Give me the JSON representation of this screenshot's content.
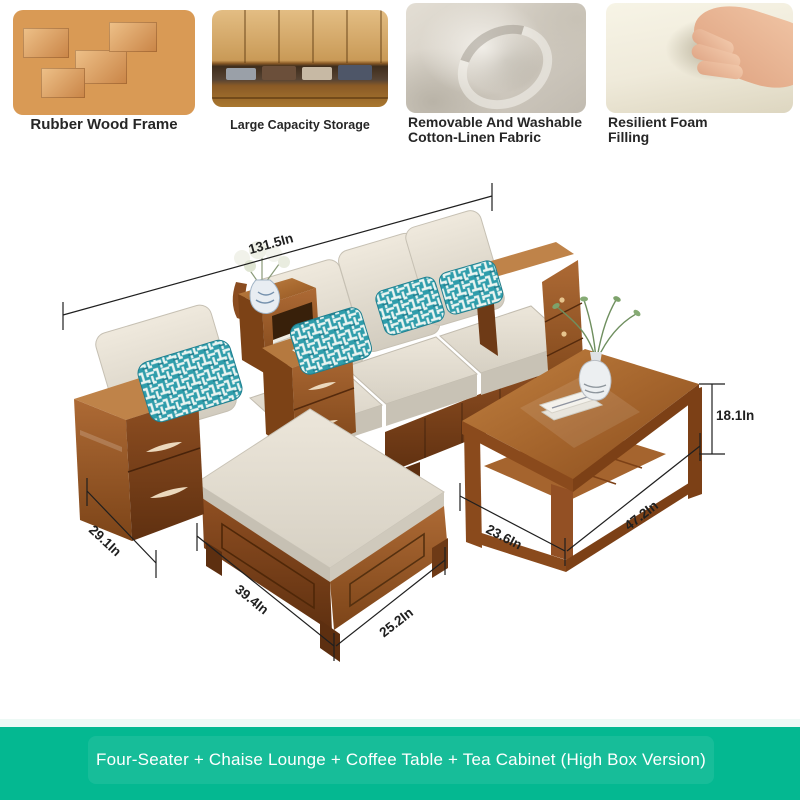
{
  "features": [
    {
      "image_name": "rubber-wood-blocks-photo",
      "caption": "Rubber Wood Frame"
    },
    {
      "image_name": "storage-drawer-photo",
      "caption": "Large Capacity Storage"
    },
    {
      "image_name": "cotton-linen-fabric-photo",
      "caption_lines": [
        "Removable And Washable",
        "Cotton-Linen Fabric"
      ]
    },
    {
      "image_name": "resilient-foam-photo",
      "caption_lines": [
        "Resilient Foam",
        "Filling"
      ]
    }
  ],
  "dimensions": {
    "sofa_length": "131.5In",
    "table_height": "18.1In",
    "armrest_depth": "29.1In",
    "chaise_length": "39.4In",
    "chaise_width": "25.2In",
    "table_depth": "23.6In",
    "table_length": "47.2In"
  },
  "banner": {
    "text": "Four-Seater + Chaise Lounge + Coffee Table + Tea Cabinet (High Box Version)",
    "background": "#04b891",
    "text_color": "#ffffff"
  },
  "colors": {
    "wood": "#96562a",
    "wood_dark": "#6b3a18",
    "cushion_cream": "#e2dccf",
    "pillow_teal": "#2f9dab",
    "dimension_line": "#1f1f1f"
  }
}
